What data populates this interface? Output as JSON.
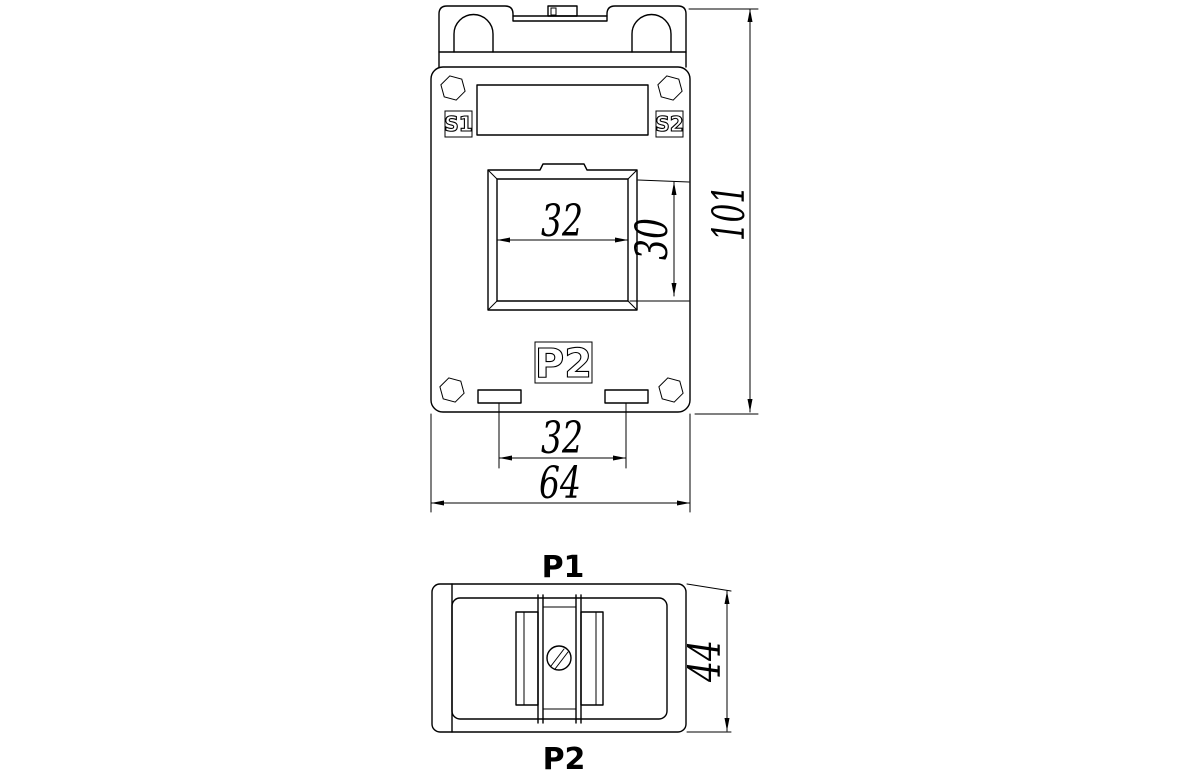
{
  "drawing": {
    "background": "#ffffff",
    "line_color": "#000000",
    "front_view": {
      "terminal_top_left": "S1",
      "terminal_top_right": "S2",
      "terminal_bottom": "P2",
      "dim_window_width": "32",
      "dim_window_height": "30",
      "dim_overall_height": "101",
      "dim_slot_spacing": "32",
      "dim_overall_width": "64"
    },
    "side_view": {
      "label_top": "P1",
      "label_bottom": "P2",
      "dim_depth": "44"
    }
  }
}
